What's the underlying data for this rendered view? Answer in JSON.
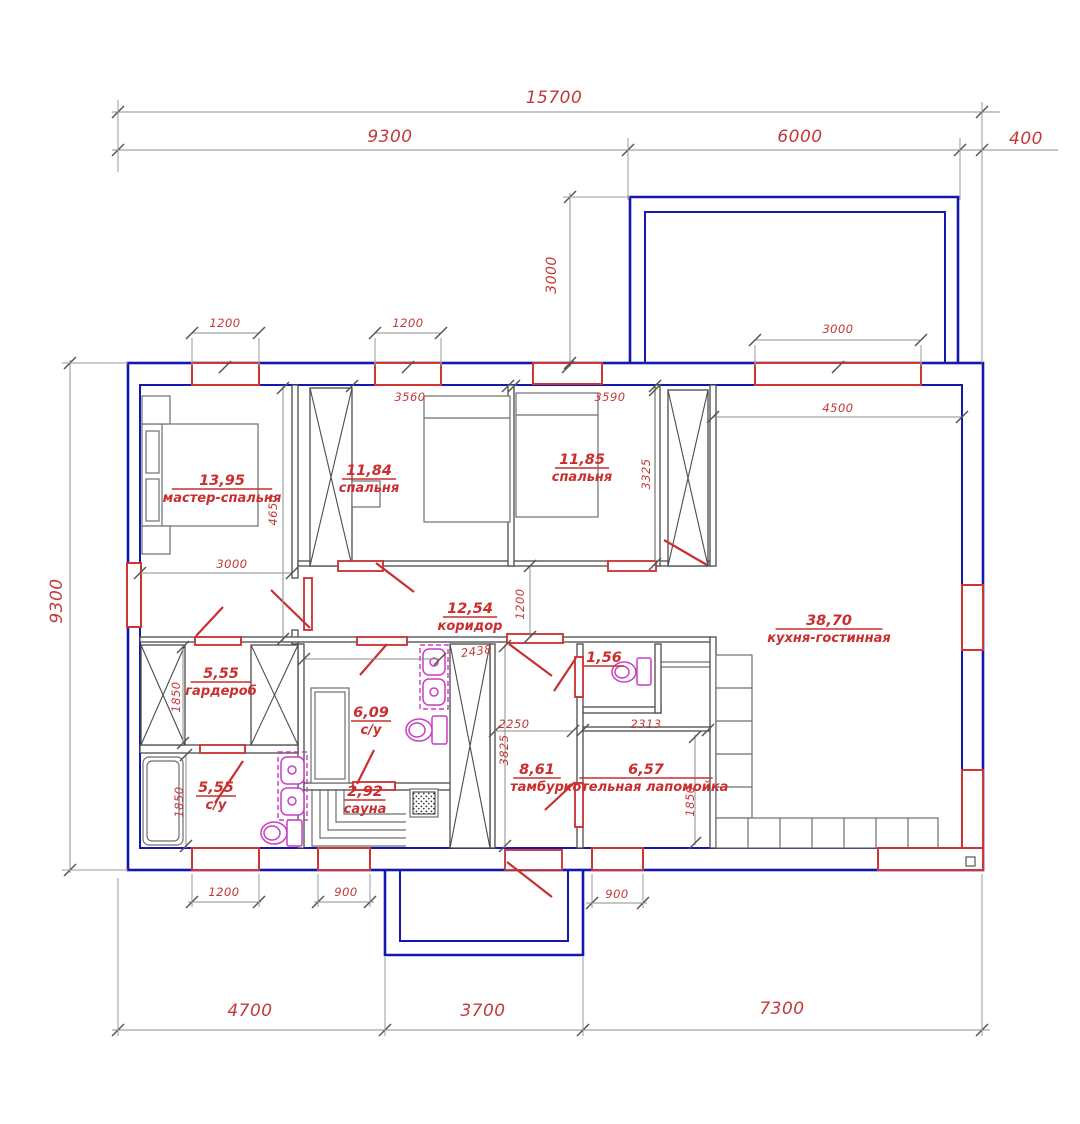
{
  "drawing": {
    "type": "floor-plan",
    "colors": {
      "wall_blue": "#1518ae",
      "annotation_red": "#c92f2f",
      "fixture_magenta": "#c93ec2"
    }
  },
  "rooms": [
    {
      "id": "master-bedroom",
      "area": "13,95",
      "name": "мастер-спальня",
      "cx": 222,
      "cy": 489
    },
    {
      "id": "bedroom-1",
      "area": "11,84",
      "name": "спальня",
      "cx": 369,
      "cy": 479
    },
    {
      "id": "bedroom-2",
      "area": "11,85",
      "name": "спальня",
      "cx": 582,
      "cy": 468
    },
    {
      "id": "kitchen-living",
      "area": "38,70",
      "name": "кухня-гостинная",
      "cx": 829,
      "cy": 629
    },
    {
      "id": "corridor",
      "area": "12,54",
      "name": "коридор",
      "cx": 470,
      "cy": 617
    },
    {
      "id": "wardrobe",
      "area": "5,55",
      "name": "гардероб",
      "cx": 221,
      "cy": 682
    },
    {
      "id": "bathroom-1",
      "area": "6,09",
      "name": "с/у",
      "cx": 371,
      "cy": 721
    },
    {
      "id": "bathroom-2",
      "area": "5,55",
      "name": "с/у",
      "cx": 216,
      "cy": 796
    },
    {
      "id": "sauna",
      "area": "2,92",
      "name": "сауна",
      "cx": 365,
      "cy": 800
    },
    {
      "id": "tambour",
      "area": "8,61",
      "name": "тамбур",
      "cx": 537,
      "cy": 778
    },
    {
      "id": "boiler-room",
      "area": "6,57",
      "name": "котельная лапомойка",
      "cx": 646,
      "cy": 778
    },
    {
      "id": "wc",
      "area": "1,56",
      "name": "",
      "cx": 604,
      "cy": 666
    }
  ],
  "dims": [
    {
      "t": "15700",
      "x": 554,
      "y": 103,
      "s": "lg"
    },
    {
      "t": "9300",
      "x": 390,
      "y": 142,
      "s": "lg"
    },
    {
      "t": "6000",
      "x": 800,
      "y": 142,
      "s": "lg"
    },
    {
      "t": "400",
      "x": 1026,
      "y": 144,
      "s": "lg"
    },
    {
      "t": "3000",
      "x": 556,
      "y": 275,
      "s": "md",
      "r": -90
    },
    {
      "t": "3000",
      "x": 838,
      "y": 333,
      "s": "sm"
    },
    {
      "t": "1200",
      "x": 225,
      "y": 327,
      "s": "sm"
    },
    {
      "t": "1200",
      "x": 408,
      "y": 327,
      "s": "sm"
    },
    {
      "t": "3560",
      "x": 410,
      "y": 401,
      "s": "sm"
    },
    {
      "t": "3590",
      "x": 610,
      "y": 401,
      "s": "sm"
    },
    {
      "t": "4500",
      "x": 838,
      "y": 412,
      "s": "sm"
    },
    {
      "t": "4650",
      "x": 277,
      "y": 510,
      "s": "sm",
      "r": -90
    },
    {
      "t": "3325",
      "x": 650,
      "y": 474,
      "s": "sm",
      "r": -90
    },
    {
      "t": "3000",
      "x": 232,
      "y": 568,
      "s": "sm"
    },
    {
      "t": "1200",
      "x": 524,
      "y": 604,
      "s": "sm",
      "r": -90
    },
    {
      "t": "2438",
      "x": 477,
      "y": 655,
      "s": "sm",
      "r": -8
    },
    {
      "t": "2250",
      "x": 514,
      "y": 728,
      "s": "sm"
    },
    {
      "t": "3825",
      "x": 508,
      "y": 750,
      "s": "sm",
      "r": -90
    },
    {
      "t": "2313",
      "x": 646,
      "y": 728,
      "s": "sm"
    },
    {
      "t": "1850",
      "x": 694,
      "y": 801,
      "s": "sm",
      "r": -90
    },
    {
      "t": "1850",
      "x": 180,
      "y": 697,
      "s": "sm",
      "r": -90
    },
    {
      "t": "1850",
      "x": 183,
      "y": 802,
      "s": "sm",
      "r": -90
    },
    {
      "t": "9300",
      "x": 62,
      "y": 601,
      "s": "lg",
      "r": -90
    },
    {
      "t": "1200",
      "x": 224,
      "y": 896,
      "s": "sm"
    },
    {
      "t": "900",
      "x": 346,
      "y": 896,
      "s": "sm"
    },
    {
      "t": "900",
      "x": 617,
      "y": 898,
      "s": "sm"
    },
    {
      "t": "4700",
      "x": 250,
      "y": 1016,
      "s": "lg"
    },
    {
      "t": "3700",
      "x": 483,
      "y": 1016,
      "s": "lg"
    },
    {
      "t": "7300",
      "x": 782,
      "y": 1014,
      "s": "lg"
    }
  ]
}
